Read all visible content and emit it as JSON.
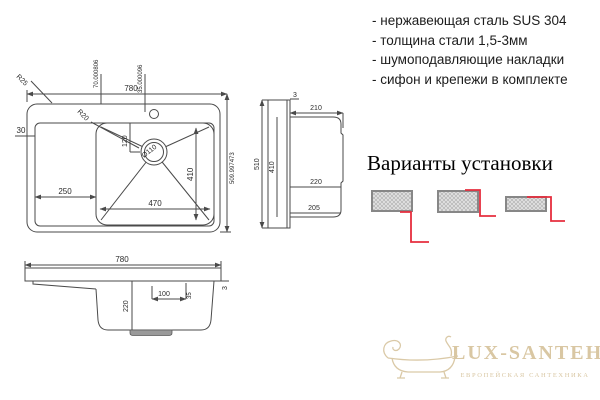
{
  "features": {
    "items": [
      "- нержавеющая сталь SUS 304",
      "- толщина стали 1,5-3мм",
      "- шумоподавляющие накладки",
      "- сифон и крепежи в комплекте"
    ]
  },
  "top_view": {
    "width": "780",
    "outer_radius": "R25",
    "inner_radius": "R20",
    "rim_left": "30",
    "hole_offset_a": "70.000806",
    "hole_offset_b": "35.000096",
    "drain_offset": "120",
    "drain_diameter": "Ø110",
    "wing_width": "250",
    "bowl_width": "470",
    "bowl_length": "410",
    "depth": "509.997473"
  },
  "side_view": {
    "rim_thickness": "3",
    "top_width": "210",
    "overall_depth": "510",
    "inner_depth": "410",
    "bowl_height": "220",
    "bottom_width": "205"
  },
  "front_view": {
    "width": "780",
    "bowl_depth": "220",
    "hole_offset": "100",
    "hole_size": "35",
    "rim_thickness": "3"
  },
  "install": {
    "title": "Варианты установки"
  },
  "watermark": {
    "brand": "LUX-SANTEH",
    "tagline": "ЕВРОПЕЙСКАЯ САНТЕХНИКА"
  },
  "colors": {
    "line": "#4a4a4a",
    "accent_red": "#e62e3e",
    "hatch_fill": "#e3e3e3",
    "hatch_border": "#878787",
    "watermark": "#d9c7a3"
  }
}
